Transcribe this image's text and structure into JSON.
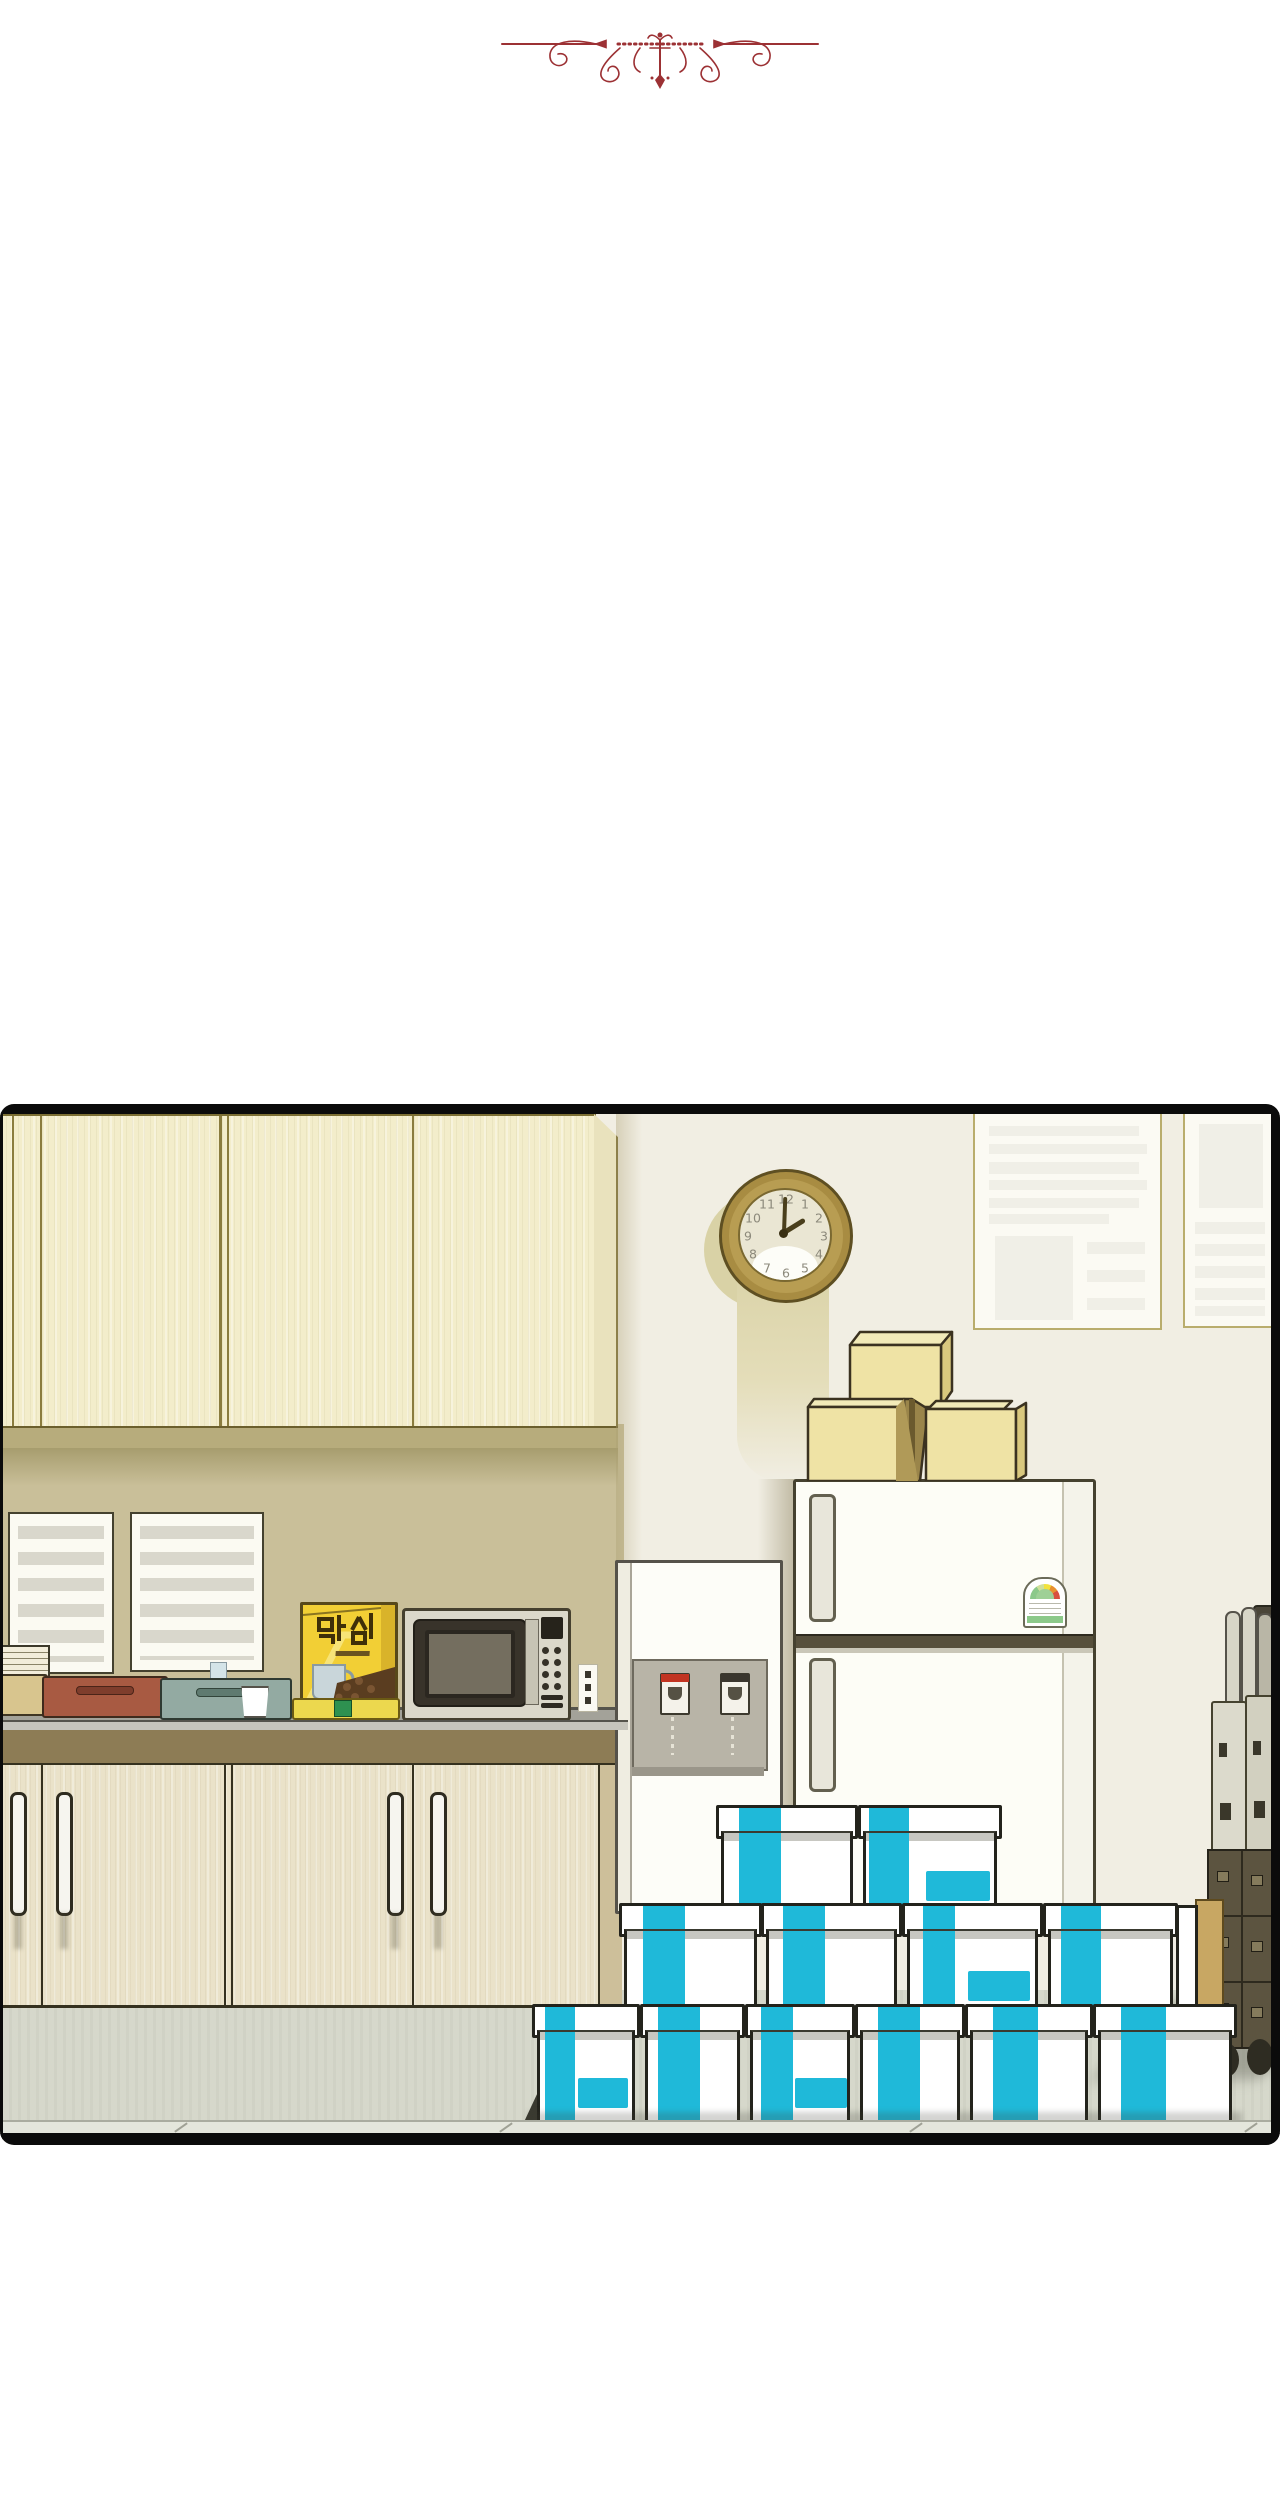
{
  "scene": {
    "kind": "webtoon panel",
    "setting": "office kitchenette with stacked supply boxes"
  },
  "ornament": {
    "name": "flourish-divider"
  },
  "colors": {
    "maroon": "#9c3134",
    "cyan": "#1fb9d9",
    "panel-border": "#0b0b0b",
    "wall": "#f1eee3",
    "wall-left": "#c9bf99",
    "floor": "#d6d8cb",
    "wood-upper": "#f3edcb",
    "wood-lower": "#eae2c9",
    "counter": "#a3a299",
    "box-yellow": "#f2cf35",
    "cardboard": "#efe3a5"
  },
  "clock": {
    "numbers": [
      "12",
      "1",
      "2",
      "3",
      "4",
      "5",
      "6",
      "7",
      "8",
      "9",
      "10",
      "11"
    ],
    "time": "2:00"
  },
  "coffee_box": {
    "brand": "막심"
  },
  "labels": {
    "fridge_magnet": "energy-rating-label"
  },
  "counts": {
    "supply_boxes": 12,
    "cardboard_boxes": 3
  }
}
